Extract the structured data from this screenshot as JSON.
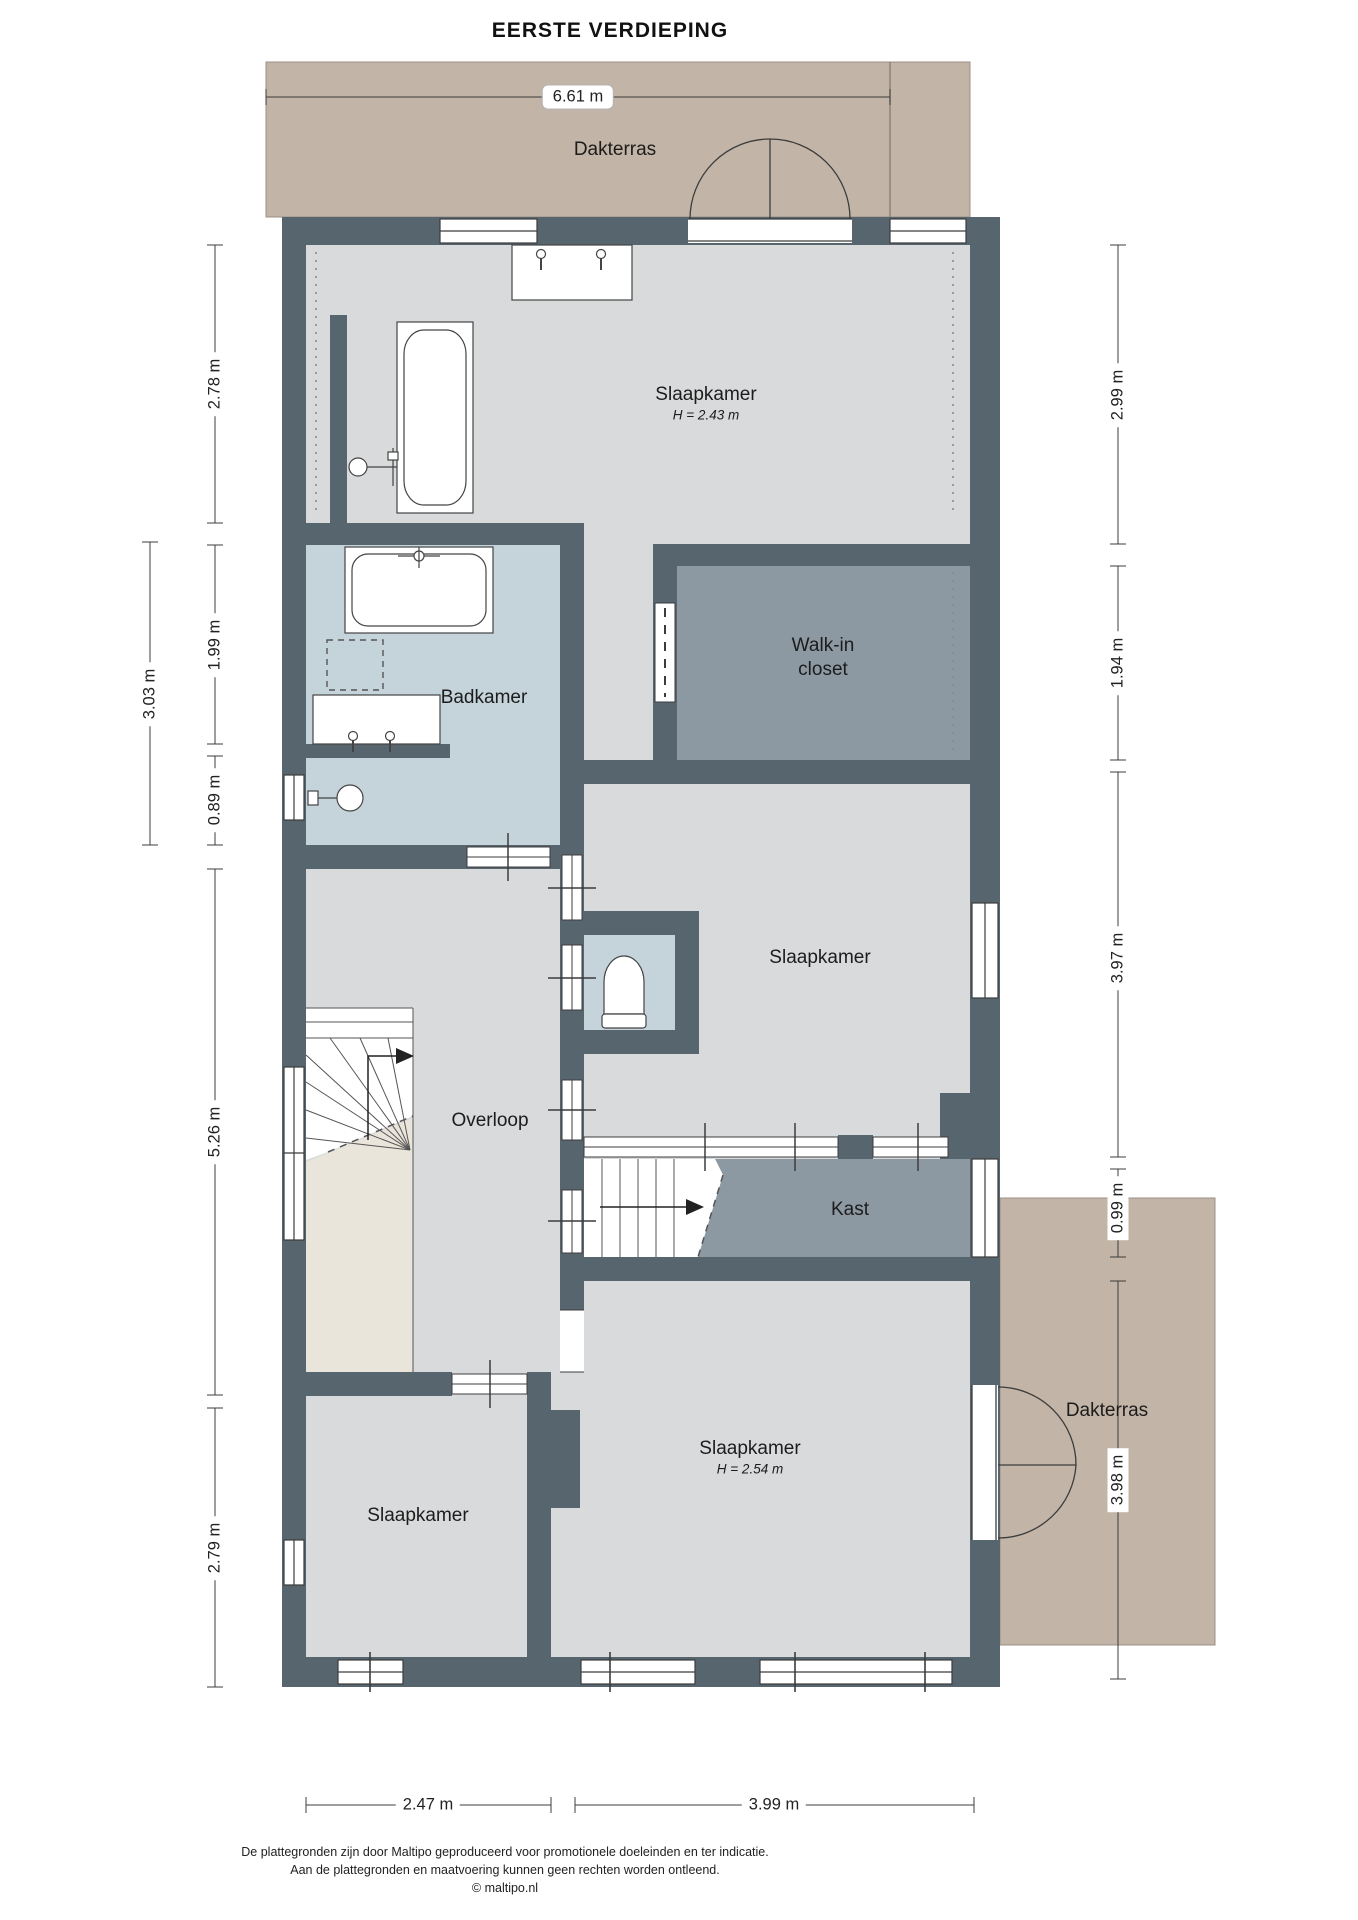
{
  "title": "EERSTE VERDIEPING",
  "labels": {
    "dakterras_top": "Dakterras",
    "slaapkamer_top": "Slaapkamer",
    "slaapkamer_top_h": "H = 2.43 m",
    "badkamer": "Badkamer",
    "walkin_line1": "Walk-in",
    "walkin_line2": "closet",
    "slaapkamer_mid": "Slaapkamer",
    "overloop": "Overloop",
    "kast": "Kast",
    "slaapkamer_bl": "Slaapkamer",
    "slaapkamer_br": "Slaapkamer",
    "slaapkamer_br_h": "H = 2.54 m",
    "dakterras_right": "Dakterras"
  },
  "dims": {
    "top": "6.61 m",
    "bottom_left": "2.47 m",
    "bottom_right": "3.99 m",
    "left_278": "2.78 m",
    "left_303": "3.03 m",
    "left_199": "1.99 m",
    "left_089": "0.89 m",
    "left_526": "5.26 m",
    "left_279": "2.79 m",
    "right_299": "2.99 m",
    "right_194": "1.94 m",
    "right_397": "3.97 m",
    "right_099": "0.99 m",
    "right_398": "3.98 m"
  },
  "footer": {
    "line1": "De plattegronden zijn door Maltipo geproduceerd voor promotionele doeleinden en ter indicatie.",
    "line2": "Aan de plattegronden en maatvoering kunnen geen rechten worden ontleend.",
    "line3": "© maltipo.nl"
  },
  "colors": {
    "wall": "#57656f",
    "floor": "#d9dadb",
    "bathroom_floor": "#c5d4da",
    "closet_floor": "#8c99a3",
    "terrace": "#c2b4a6",
    "void_beige": "#eae5da",
    "line": "#3c3c3c"
  }
}
